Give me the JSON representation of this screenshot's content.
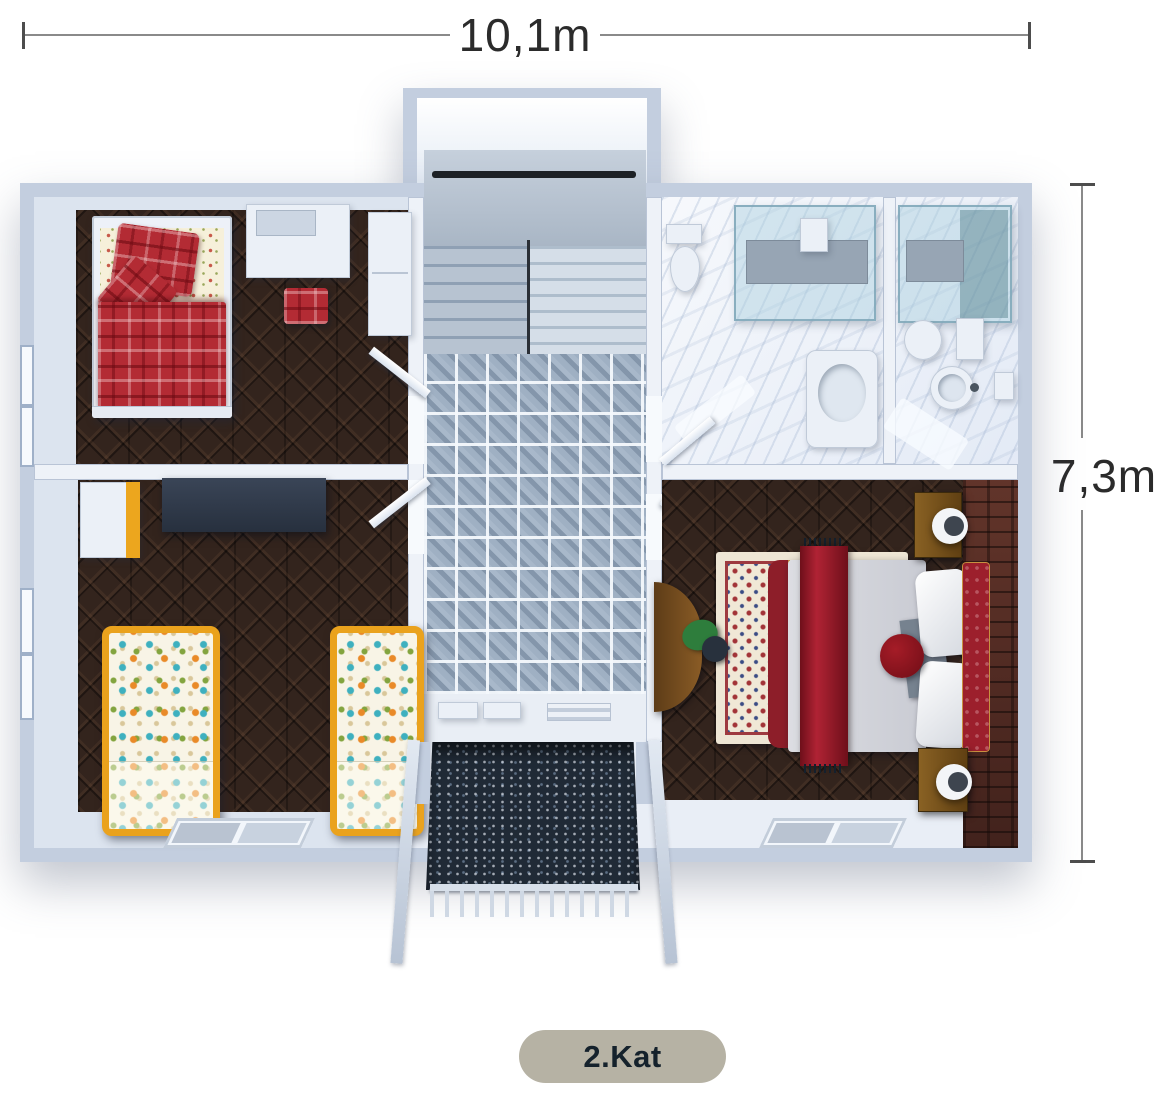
{
  "dimension_labels": {
    "width": "10,1m",
    "height": "7,3m"
  },
  "floor_badge": {
    "label": "2.Kat"
  },
  "palette": {
    "badge_bg": "#b6b2a4",
    "badge_text": "#15222c",
    "outer_wall": "#c3cedf",
    "inner_wall": "#eef2f8",
    "dark_wood_floor": "#33241d",
    "hall_tile": "#9fb0c3",
    "bath_marble": "#e7edf7",
    "brick_accent_wall": "#502b24",
    "plaid_red_bed": "#b32b34",
    "kids_bed_frame_yellow": "#eaa21d",
    "master_bed_red": "#9c1f2c",
    "balcony_stair_dark": "#202a36",
    "dimension_line": "#8a8a8a",
    "dimension_text": "#2b2b2b"
  }
}
